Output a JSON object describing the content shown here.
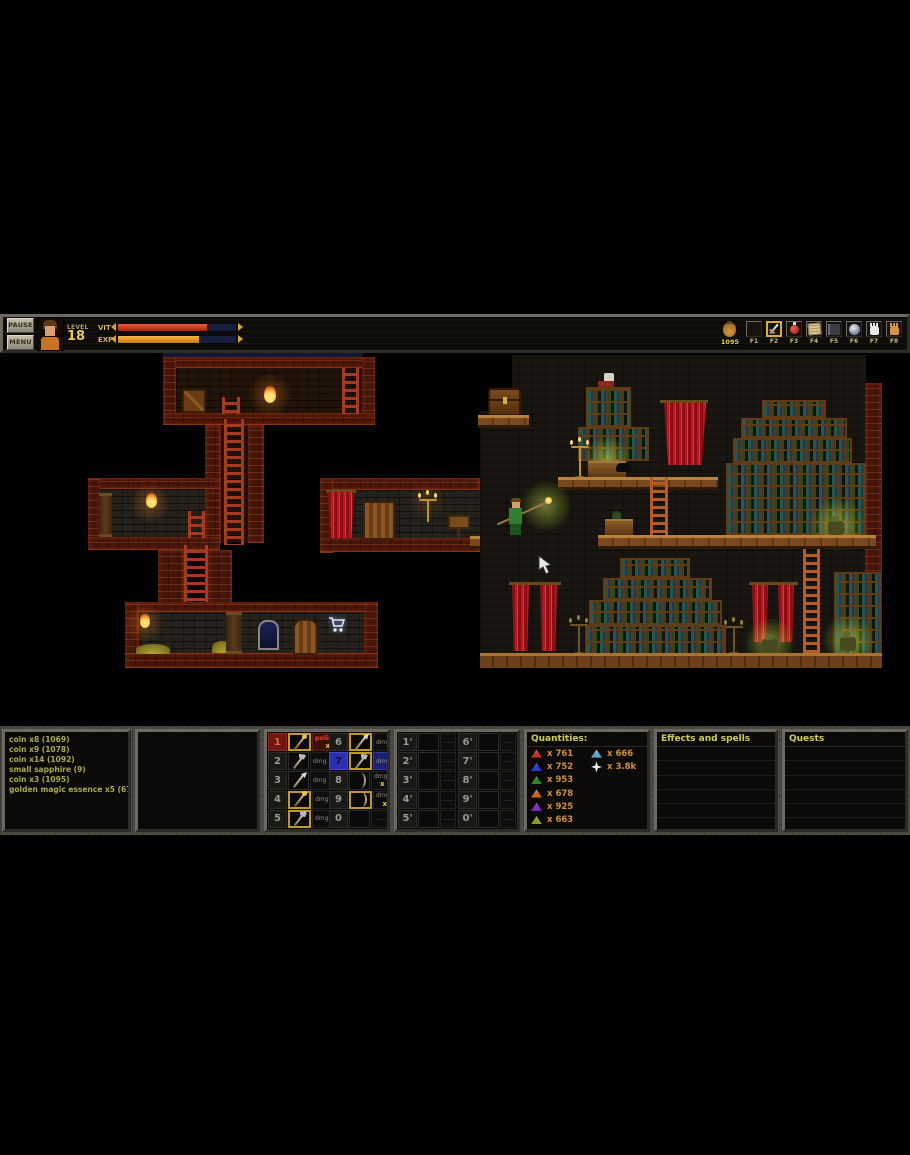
{
  "hud": {
    "pause_label": "PAUSE",
    "menu_label": "MENU",
    "level_label": "LEVEL",
    "level_value": "18",
    "vit_label": "VIT",
    "exp_label": "EXP",
    "vit_percent": 75,
    "exp_percent": 69,
    "gold_amount": "1095",
    "function_keys": [
      {
        "key": "F1",
        "icon": "empty",
        "selected": false
      },
      {
        "key": "F2",
        "icon": "sword-icon",
        "selected": true
      },
      {
        "key": "F3",
        "icon": "potion-icon",
        "selected": false
      },
      {
        "key": "F4",
        "icon": "scroll-icon",
        "selected": false
      },
      {
        "key": "F5",
        "icon": "book-icon",
        "selected": false
      },
      {
        "key": "F6",
        "icon": "orb-icon",
        "selected": false
      },
      {
        "key": "F7",
        "icon": "white-hand-icon",
        "selected": false
      },
      {
        "key": "F8",
        "icon": "orange-hand-icon",
        "selected": false
      }
    ]
  },
  "log_panel": {
    "lines": [
      "coin x8 (1069)",
      "coin x9 (1078)",
      "coin x14 (1092)",
      "small sapphire (9)",
      "coin x3 (1095)",
      "golden magic essence x5 (678)"
    ]
  },
  "hotbar": {
    "dmg_label": "dmg",
    "slots": [
      {
        "key": "1",
        "icon": "staff-icon",
        "line1": "polimorf!",
        "line2": "x 8"
      },
      {
        "key": "2",
        "icon": "axe-icon",
        "dmg": "45"
      },
      {
        "key": "3",
        "icon": "spear-icon",
        "dmg": "160"
      },
      {
        "key": "4",
        "icon": "staff-icon",
        "dmg": "240"
      },
      {
        "key": "5",
        "icon": "axe-icon",
        "dmg": "280"
      },
      {
        "key": "6",
        "icon": "spear-icon",
        "dmg": "160"
      },
      {
        "key": "7",
        "icon": "axe-icon",
        "dmg": "260"
      },
      {
        "key": "8",
        "icon": "bow-icon",
        "dmg": "70",
        "qty": "x 4.4k"
      },
      {
        "key": "9",
        "icon": "bow-icon",
        "dmg": "150",
        "qty": "x 675"
      },
      {
        "key": "0",
        "icon": "empty"
      }
    ]
  },
  "hotbar2": {
    "slots": [
      "1'",
      "2'",
      "3'",
      "4'",
      "5'",
      "6'",
      "7'",
      "8'",
      "9'",
      "0'"
    ]
  },
  "quantities": {
    "title": "Quantities:",
    "rows": [
      {
        "icon": "red-gem",
        "qty": "x 761",
        "icon2": "cyan-gem",
        "qty2": "x 666"
      },
      {
        "icon": "blue-gem",
        "qty": "x 752",
        "icon2": "star-gem",
        "qty2": "x 3.8k"
      },
      {
        "icon": "green-gem",
        "qty": "x 953"
      },
      {
        "icon": "orange-gem",
        "qty": "x 678"
      },
      {
        "icon": "purple-gem",
        "qty": "x 925"
      },
      {
        "icon": "lime-gem",
        "qty": "x 663"
      }
    ]
  },
  "effects_panel": {
    "title": "Effects and spells"
  },
  "quests_panel": {
    "title": "Quests"
  },
  "colors": {
    "vit_bar": "#cf2a1c",
    "exp_bar": "#e2921c",
    "gold_text": "#e8d040",
    "header_text": "#cfd045",
    "log_text": "#a8ab46",
    "dmg_value": "#4a66e8",
    "quantity_text": "#d29035",
    "selected_slot_red": "#6e1710",
    "selected_slot_blue": "#2c2fae",
    "equipped_border": "#c09a28"
  }
}
